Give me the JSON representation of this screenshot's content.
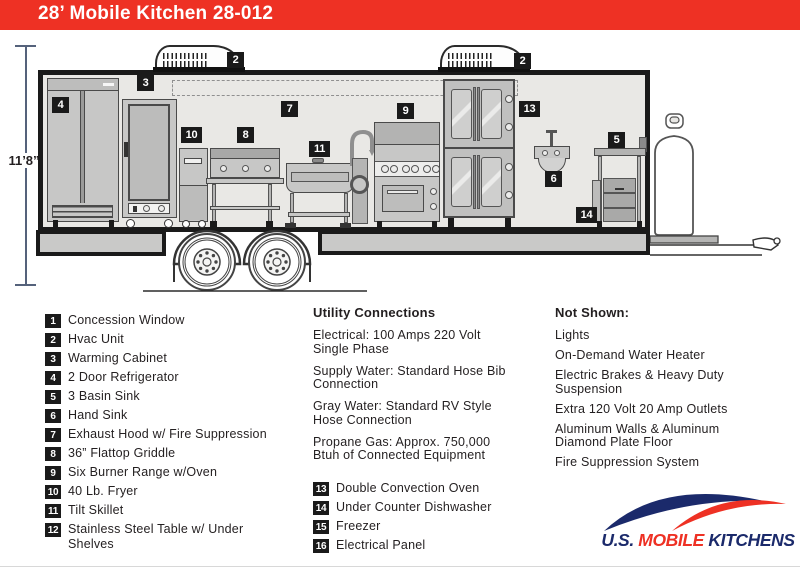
{
  "header": {
    "title": "28’ Mobile Kitchen 28-012"
  },
  "diagram": {
    "height_label": "11’8”",
    "badge_labels": {
      "2": "2",
      "3": "3",
      "4": "4",
      "5": "5",
      "6": "6",
      "7": "7",
      "8": "8",
      "9": "9",
      "10": "10",
      "11": "11",
      "13": "13",
      "14": "14"
    }
  },
  "legend": {
    "items": [
      {
        "num": "1",
        "label": "Concession Window"
      },
      {
        "num": "2",
        "label": "Hvac Unit"
      },
      {
        "num": "3",
        "label": "Warming Cabinet"
      },
      {
        "num": "4",
        "label": "2 Door Refrigerator"
      },
      {
        "num": "5",
        "label": "3 Basin Sink"
      },
      {
        "num": "6",
        "label": "Hand Sink"
      },
      {
        "num": "7",
        "label": "Exhaust Hood w/ Fire Suppression"
      },
      {
        "num": "8",
        "label": "36” Flattop Griddle"
      },
      {
        "num": "9",
        "label": "Six Burner Range w/Oven"
      },
      {
        "num": "10",
        "label": "40 Lb. Fryer"
      },
      {
        "num": "11",
        "label": "Tilt Skillet"
      },
      {
        "num": "12",
        "label": "Stainless Steel Table w/ Under Shelves"
      },
      {
        "num": "13",
        "label": "Double Convection Oven"
      },
      {
        "num": "14",
        "label": "Under Counter Dishwasher"
      },
      {
        "num": "15",
        "label": "Freezer"
      },
      {
        "num": "16",
        "label": "Electrical Panel"
      }
    ],
    "utility": {
      "heading": "Utility Connections",
      "lines": [
        "Electrical: 100 Amps 220 Volt Single Phase",
        "Supply Water: Standard Hose Bib Connection",
        "Gray Water: Standard RV Style Hose Connection",
        "Propane Gas: Approx. 750,000 Btuh of Connected Equipment"
      ]
    },
    "not_shown": {
      "heading": "Not Shown:",
      "items": [
        "Lights",
        "On-Demand Water Heater",
        "Electric Brakes & Heavy Duty Suspension",
        "Extra 120 Volt 20 Amp Outlets",
        "Aluminum Walls & Aluminum Diamond Plate Floor",
        "Fire Suppression System"
      ]
    }
  },
  "logo": {
    "part1": "U.S.",
    "part2": "MOBILE",
    "part3": "KITCHENS"
  },
  "colors": {
    "header_red": "#EE3124",
    "logo_navy": "#1B2A6B",
    "logo_red": "#EE3124",
    "badge_black": "#1A1A1A"
  }
}
